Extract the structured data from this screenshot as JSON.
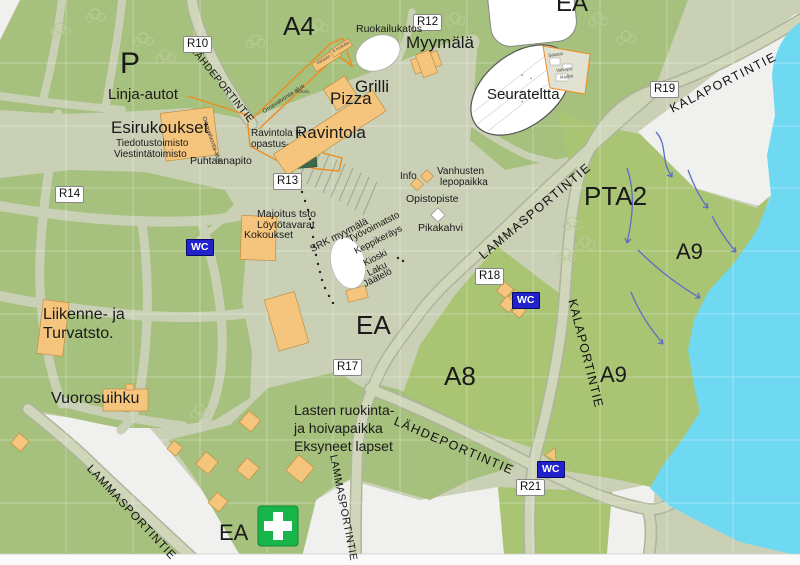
{
  "map": {
    "roads": {
      "lahdeportintie": "LÄHDEPORTINTIE",
      "lammasportintie": "LAMMASPORTINTIE",
      "kalaportintie": "KALAPORTINTIE"
    },
    "gates": {
      "r10": "R10",
      "r12": "R12",
      "r13": "R13",
      "r14": "R14",
      "r17": "R17",
      "r18": "R18",
      "r19": "R19",
      "r21": "R21"
    },
    "areas": {
      "a4": "A4",
      "p": "P",
      "ea": "EA",
      "pta2": "PTA2",
      "a8": "A8",
      "a9": "A9"
    },
    "facilities": {
      "wc": "WC"
    },
    "places": {
      "linja_autot": "Linja-autot",
      "esirukoukset": "Esirukoukset",
      "tiedotustoimisto": "Tiedotustoimisto",
      "viestintatoimisto": "Viestintätoimisto",
      "puhtaanapito": "Puhtaanapito",
      "ravintola_tt": "Ravintola tt",
      "opastus": "opastus",
      "ravintola": "Ravintola",
      "pizza": "Pizza",
      "grilli": "Grilli",
      "ruokailukatos": "Ruokailukatos",
      "myymala": "Myymälä",
      "seurateltta": "Seurateltta",
      "info": "Info",
      "vanhusten": "Vanhusten",
      "lepopaikka": "lepopaikka",
      "opistopiste": "Opistopiste",
      "pikakahvi": "Pikakahvi",
      "majoitus_tsto": "Majoitus tsto",
      "loytotavarat": "Löytötavarat",
      "kokoukset": "Kokoukset",
      "srk_myymala": "SRK myymälä",
      "tyovoimatsto": "Työvoimatsto",
      "keppikerays": "Keppikeräys",
      "kioski": "Kioski",
      "laku": "Laku",
      "jaatelo": "Jäätelö",
      "liikenne_ja": "Liikenne- ja",
      "turvatsto": "Turvatsto.",
      "vuorosuihku": "Vuorosuihku",
      "lasten_1": "Lasten ruokinta-",
      "lasten_2": "ja hoivapaikka",
      "lasten_3": "Eksyneet lapset",
      "omavalvonta": "Omavalvonta-alue",
      "varasto": "Varasto",
      "tt_ruokala": "tt ruokala",
      "voitelu": "Voitelu",
      "sakasti": "Sakasti",
      "valvojat": "Valvojat",
      "radiot": "Radiot"
    },
    "colors": {
      "field_green": "#a6c07d",
      "camp_green": "#a9c473",
      "path_sage": "#c9d0b6",
      "building_orange": "#f6c57d",
      "boundary_orange": "#f08b1e",
      "water_blue": "#6fd9f2",
      "wc_blue": "#2222cc",
      "first_aid_green": "#18b54a"
    }
  }
}
